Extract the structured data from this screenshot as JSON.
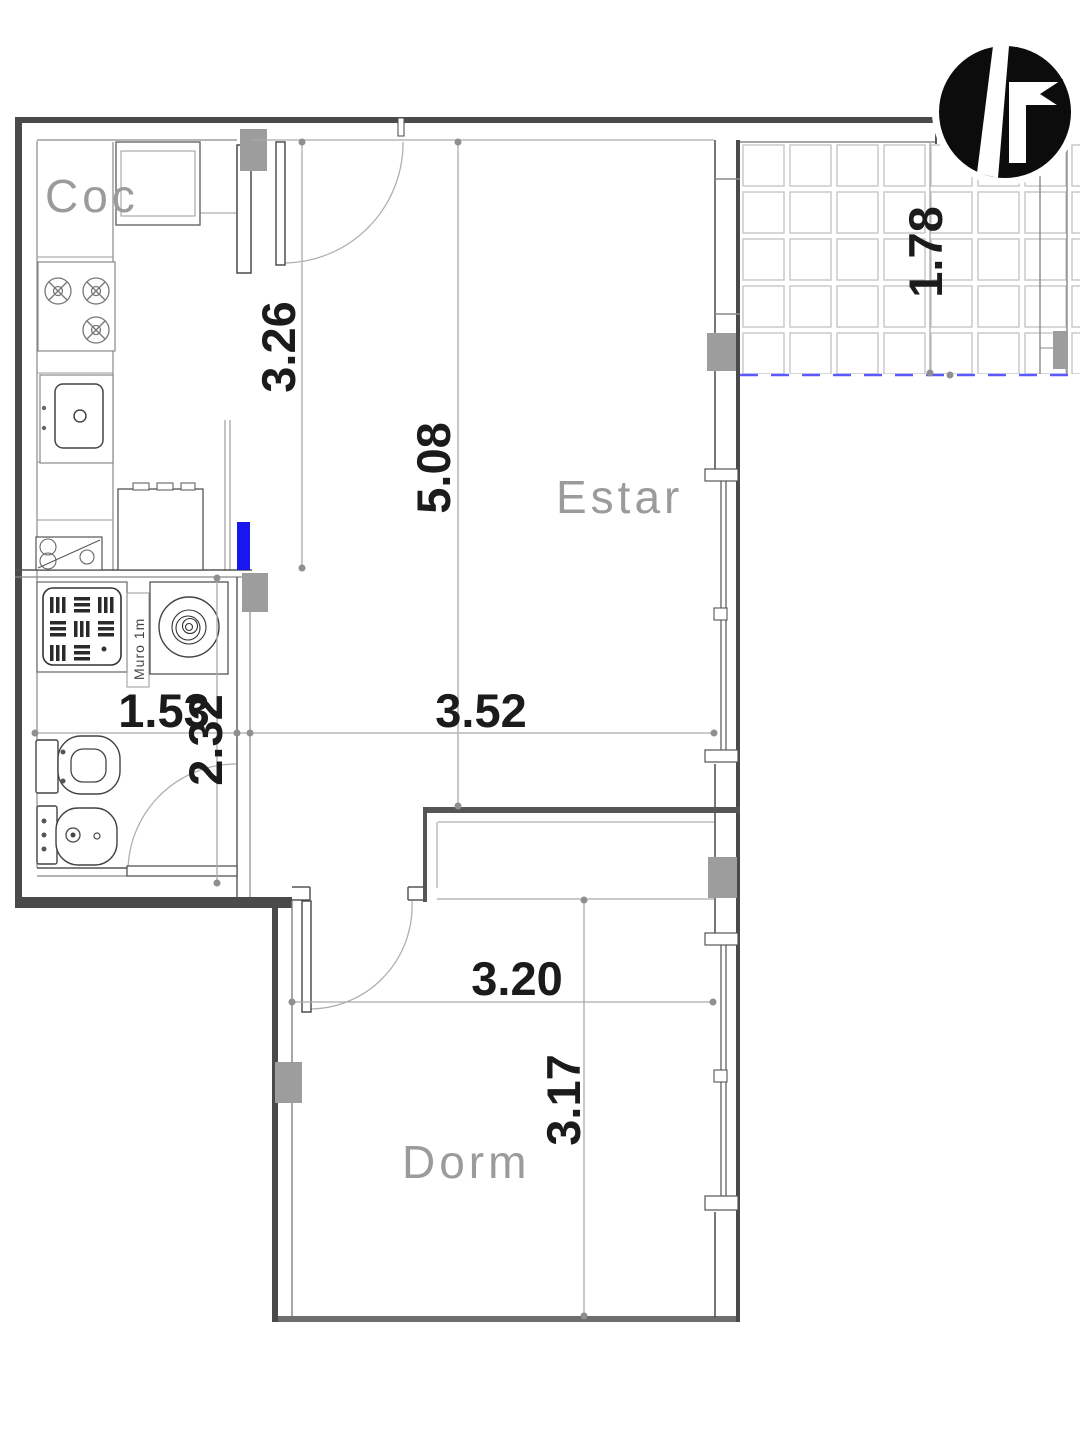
{
  "plan": {
    "type": "apartment-floor-plan",
    "rooms": {
      "kitchen": {
        "label": "Coc"
      },
      "living": {
        "label": "Estar"
      },
      "bedroom": {
        "label": "Dorm"
      }
    },
    "annotations": {
      "muro": "Muro 1m"
    },
    "dimensions": {
      "kitchen_depth": {
        "value": "3.26",
        "orientation": "vertical"
      },
      "living_depth": {
        "value": "5.08",
        "orientation": "vertical"
      },
      "balcony_depth": {
        "value": "1.78",
        "orientation": "vertical"
      },
      "bath_width": {
        "value": "1.53",
        "orientation": "horizontal"
      },
      "bath_depth": {
        "value": "2.32",
        "orientation": "vertical"
      },
      "living_width": {
        "value": "3.52",
        "orientation": "horizontal"
      },
      "bedroom_width": {
        "value": "3.20",
        "orientation": "horizontal"
      },
      "bedroom_depth": {
        "value": "3.17",
        "orientation": "vertical"
      }
    },
    "colors": {
      "wall": "#4a4a4a",
      "column": "#9d9d9d",
      "highlight_blue": "#1717ee",
      "balcony_edge_dashed": "#5a5aff",
      "dimension_line": "#ababab",
      "room_label": "#9b9b9b",
      "tile_grid": "#c6c6c6"
    }
  }
}
